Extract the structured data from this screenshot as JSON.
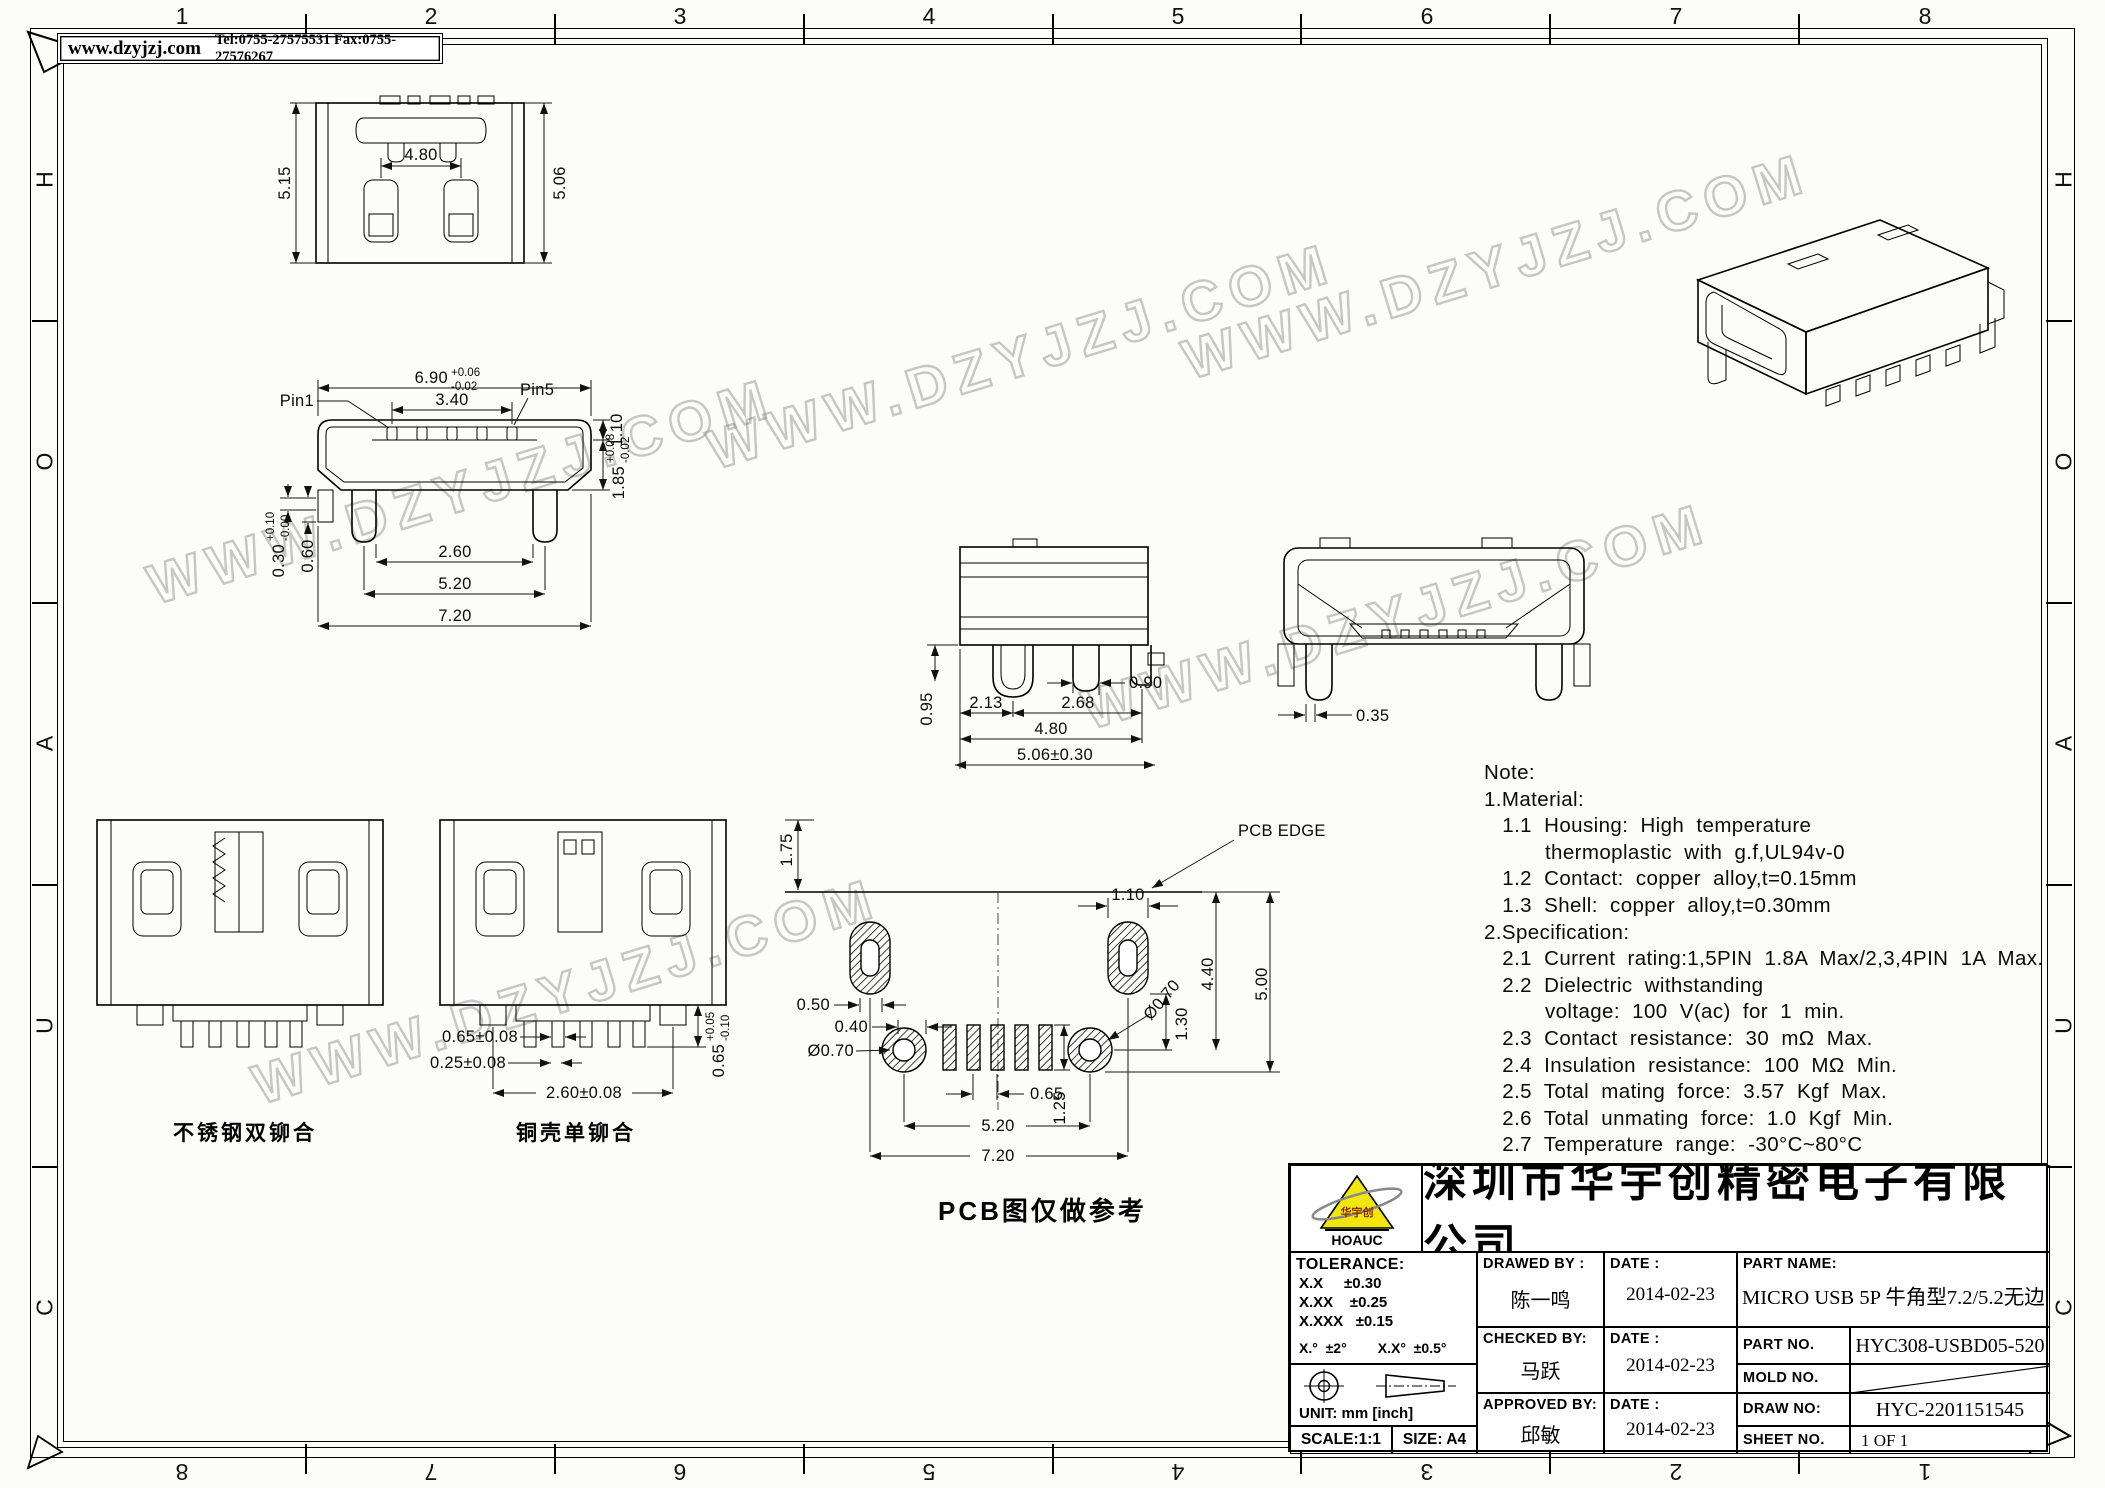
{
  "frame": {
    "top_numbers": [
      "1",
      "2",
      "3",
      "4",
      "5",
      "6",
      "7",
      "8"
    ],
    "bottom_numbers": [
      "8",
      "7",
      "6",
      "5",
      "4",
      "3",
      "2",
      "1"
    ],
    "left_letters": [
      "H",
      "O",
      "A",
      "U",
      "C"
    ],
    "right_letters": [
      "H",
      "O",
      "A",
      "U",
      "C"
    ]
  },
  "header": {
    "site": "www.dzyjzj.com",
    "contact": "Tel:0755-27575531  Fax:0755-27576267"
  },
  "watermark": {
    "text": "WWW.DZYJZJ.COM"
  },
  "views": {
    "top": {
      "dim_left": "5.15",
      "dim_inner": "4.80",
      "dim_right": "5.06"
    },
    "front": {
      "pin1": "Pin1",
      "pin5": "Pin5",
      "width": "6.90",
      "width_tp": "+0.06",
      "width_tm": "-0.02",
      "pin_span": "3.40",
      "pin_depth": "1.10",
      "step1": "0.30",
      "step1_tp": "+0.10",
      "step1_tm": "-0.00",
      "step2": "0.60",
      "height": "1.85",
      "height_tp": "+0.08",
      "height_tm": "-0.02",
      "legs_inner": "2.60",
      "legs_span": "5.20",
      "total_width": "7.20"
    },
    "side": {
      "body": "0.95",
      "a": "2.13",
      "leg": "0.90",
      "b": "2.68",
      "span": "4.80",
      "total": "5.06±0.30"
    },
    "rear": {
      "leg": "0.35"
    },
    "detail1": {
      "label": "不锈钢双铆合"
    },
    "detail2": {
      "label": "铜壳单铆合",
      "a": "0.65±0.08",
      "b": "0.25±0.08",
      "c": "2.60±0.08",
      "d": "0.65",
      "d_tp": "+0.05",
      "d_tm": "-0.10"
    },
    "pcb": {
      "edge": "PCB EDGE",
      "caption": "PCB图仅做参考",
      "offset": "1.75",
      "slot_w": "1.10",
      "off1": "0.50",
      "off2": "0.40",
      "hole_l": "Ø0.70",
      "hole_r": "Ø0.70",
      "v1": "1.30",
      "v2": "4.40",
      "v3": "5.00",
      "pitch": "0.65",
      "pad_h": "1.25",
      "hole_span": "5.20",
      "total": "7.20"
    }
  },
  "notes": {
    "lines": [
      "Note:",
      "1.Material:",
      "   1.1  Housing:  High  temperature",
      "          thermoplastic  with  g.f,UL94v-0",
      "   1.2  Contact:  copper  alloy,t=0.15mm",
      "   1.3  Shell:  copper  alloy,t=0.30mm",
      "2.Specification:",
      "   2.1  Current  rating:1,5PIN  1.8A  Max/2,3,4PIN  1A  Max.",
      "   2.2  Dielectric  withstanding",
      "          voltage:  100  V(ac)  for  1  min.",
      "   2.3  Contact  resistance:  30  mΩ  Max.",
      "   2.4  Insulation  resistance:  100  MΩ  Min.",
      "   2.5  Total  mating  force:  3.57  Kgf  Max.",
      "   2.6  Total  unmating  force:  1.0  Kgf  Min.",
      "   2.7  Temperature  range:  -30°C~80°C"
    ]
  },
  "title_block": {
    "company": "深圳市华宇创精密电子有限公司",
    "logo_inner": "华宇创",
    "logo_text": "HOAUC",
    "tolerance_title": "TOLERANCE:",
    "tolerance_lines": [
      "X.X     ±0.30",
      "X.XX    ±0.25",
      "X.XXX   ±0.15"
    ],
    "tolerance_angles": "X.°  ±2°        X.X°  ±0.5°",
    "unit": "UNIT:  mm  [inch]",
    "scale": "SCALE:1:1",
    "size": "SIZE:  A4",
    "drawed_label": "DRAWED BY :",
    "drawed_by": "陈一鸣",
    "checked_label": "CHECKED BY:",
    "checked_by": "马跃",
    "approved_label": "APPROVED BY:",
    "approved_by": "邱敏",
    "date_label": "DATE :",
    "date_drawed": "2014-02-23",
    "date_checked": "2014-02-23",
    "date_approved": "2014-02-23",
    "part_name_label": "PART NAME:",
    "part_name": "MICRO USB 5P 牛角型7.2/5.2无边",
    "part_no_label": "PART NO.",
    "part_no": "HYC308-USBD05-520",
    "mold_no_label": "MOLD NO.",
    "draw_no_label": "DRAW NO:",
    "draw_no": "HYC-2201151545",
    "sheet_no_label": "SHEET NO.",
    "sheet_no": "1 OF 1"
  }
}
